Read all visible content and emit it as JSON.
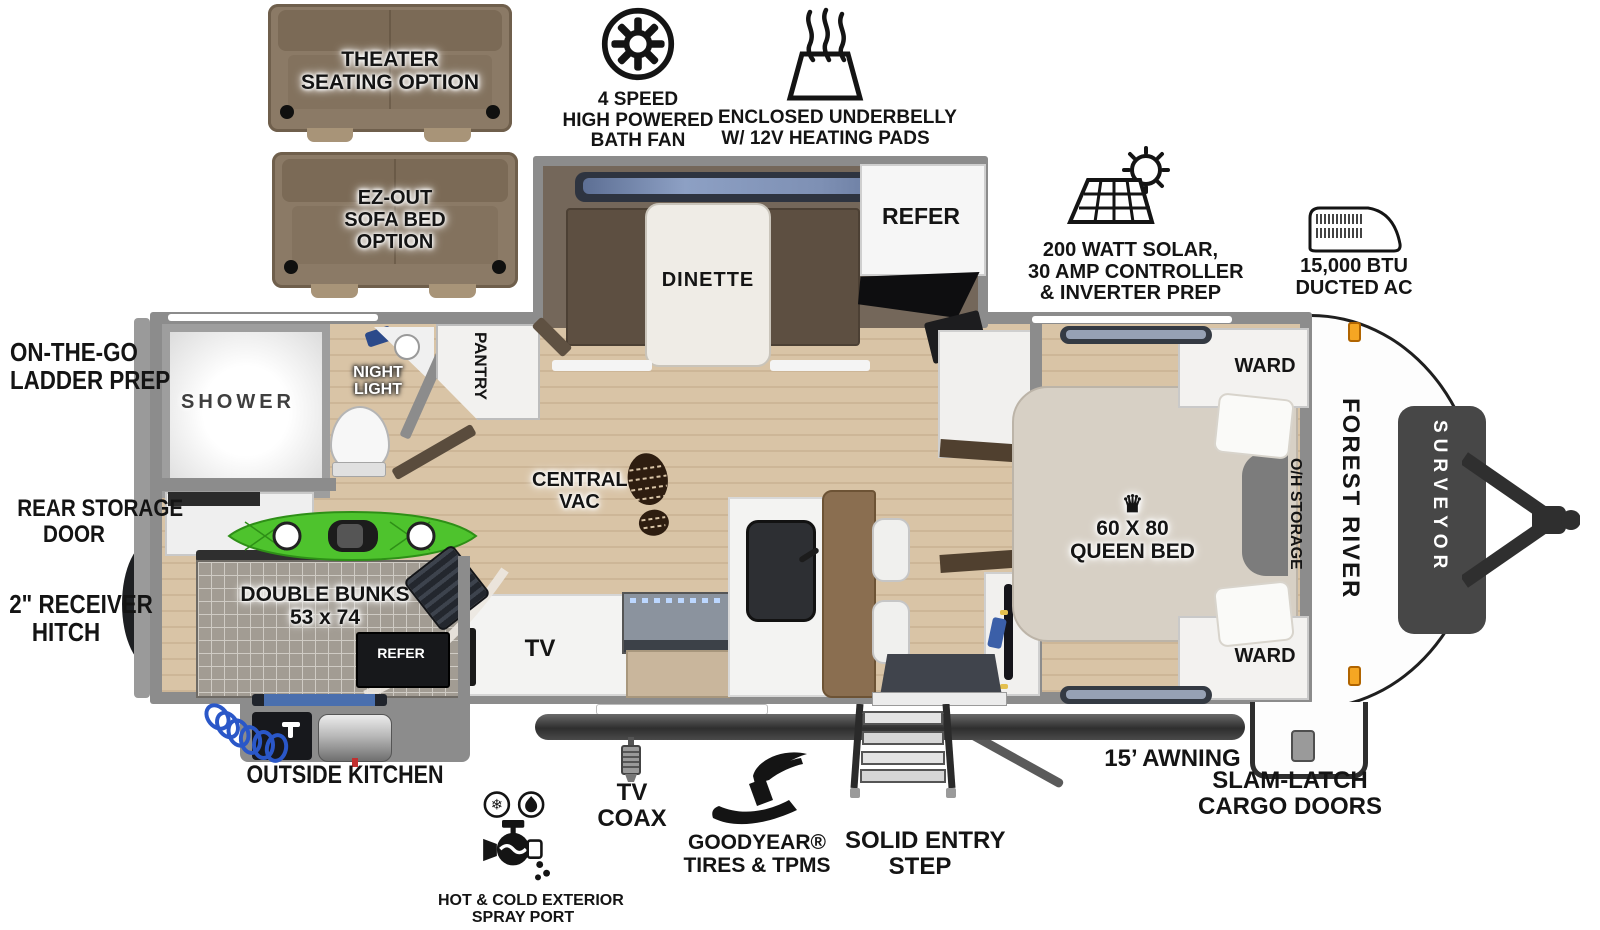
{
  "page": {
    "background": "#ffffff"
  },
  "branding": {
    "make": "FOREST RIVER",
    "model": "SURVEYOR"
  },
  "colors": {
    "wall": "#8c8c8c",
    "floor_wood": "#d9c4a6",
    "slide_floor": "#74675a",
    "marker_light_orange": "#f5a623",
    "kayak_green": "#4ec32d",
    "window_blue": "#96a1b4",
    "counter_brown": "#8a6e50",
    "sofa_brown": "#8b7a66"
  },
  "callouts": {
    "theater_seating": {
      "line1": "THEATER",
      "line2": "SEATING OPTION"
    },
    "ez_out_sofa": {
      "line1": "EZ-OUT",
      "line2": "SOFA BED",
      "line3": "OPTION"
    },
    "bath_fan": {
      "line1": "4 SPEED",
      "line2": "HIGH POWERED",
      "line3": "BATH FAN"
    },
    "underbelly": {
      "line1": "ENCLOSED UNDERBELLY",
      "line2": "W/ 12V HEATING PADS"
    },
    "solar": {
      "line1": "200 WATT SOLAR,",
      "line2": "30 AMP CONTROLLER",
      "line3": "& INVERTER PREP"
    },
    "ducted_ac": {
      "line1": "15,000 BTU",
      "line2": "DUCTED AC"
    },
    "ladder_prep": {
      "line1": "ON-THE-GO",
      "line2": "LADDER PREP"
    },
    "rear_storage_door": {
      "line1": "REAR STORAGE",
      "line2": "DOOR"
    },
    "receiver_hitch": {
      "line1": "2\" RECEIVER",
      "line2": "HITCH"
    },
    "outside_kitchen": {
      "line1": "OUTSIDE KITCHEN"
    },
    "spray_port": {
      "line1": "HOT & COLD EXTERIOR",
      "line2": "SPRAY PORT"
    },
    "tv_coax": {
      "line1": "TV",
      "line2": "COAX"
    },
    "goodyear": {
      "line1": "GOODYEAR®",
      "line2": "TIRES & TPMS"
    },
    "entry_step": {
      "line1": "SOLID ENTRY",
      "line2": "STEP"
    },
    "awning": {
      "line1": "15’ AWNING"
    },
    "cargo_doors": {
      "line1": "SLAM-LATCH",
      "line2": "CARGO DOORS"
    }
  },
  "rooms": {
    "shower": "SHOWER",
    "night_light": {
      "line1": "NIGHT",
      "line2": "LIGHT"
    },
    "pantry": "PANTRY",
    "dinette": "DINETTE",
    "refer_main": "REFER",
    "central_vac": {
      "line1": "CENTRAL",
      "line2": "VAC"
    },
    "tv": "TV",
    "double_bunks": {
      "line1": "DOUBLE BUNKS",
      "line2": "53 x 74"
    },
    "refer_outside": "REFER",
    "queen_bed": {
      "crown": "♛",
      "line1": "60 X 80",
      "line2": "QUEEN BED"
    },
    "ward_top": "WARD",
    "ward_bottom": "WARD",
    "oh_storage": "O/H STORAGE"
  }
}
